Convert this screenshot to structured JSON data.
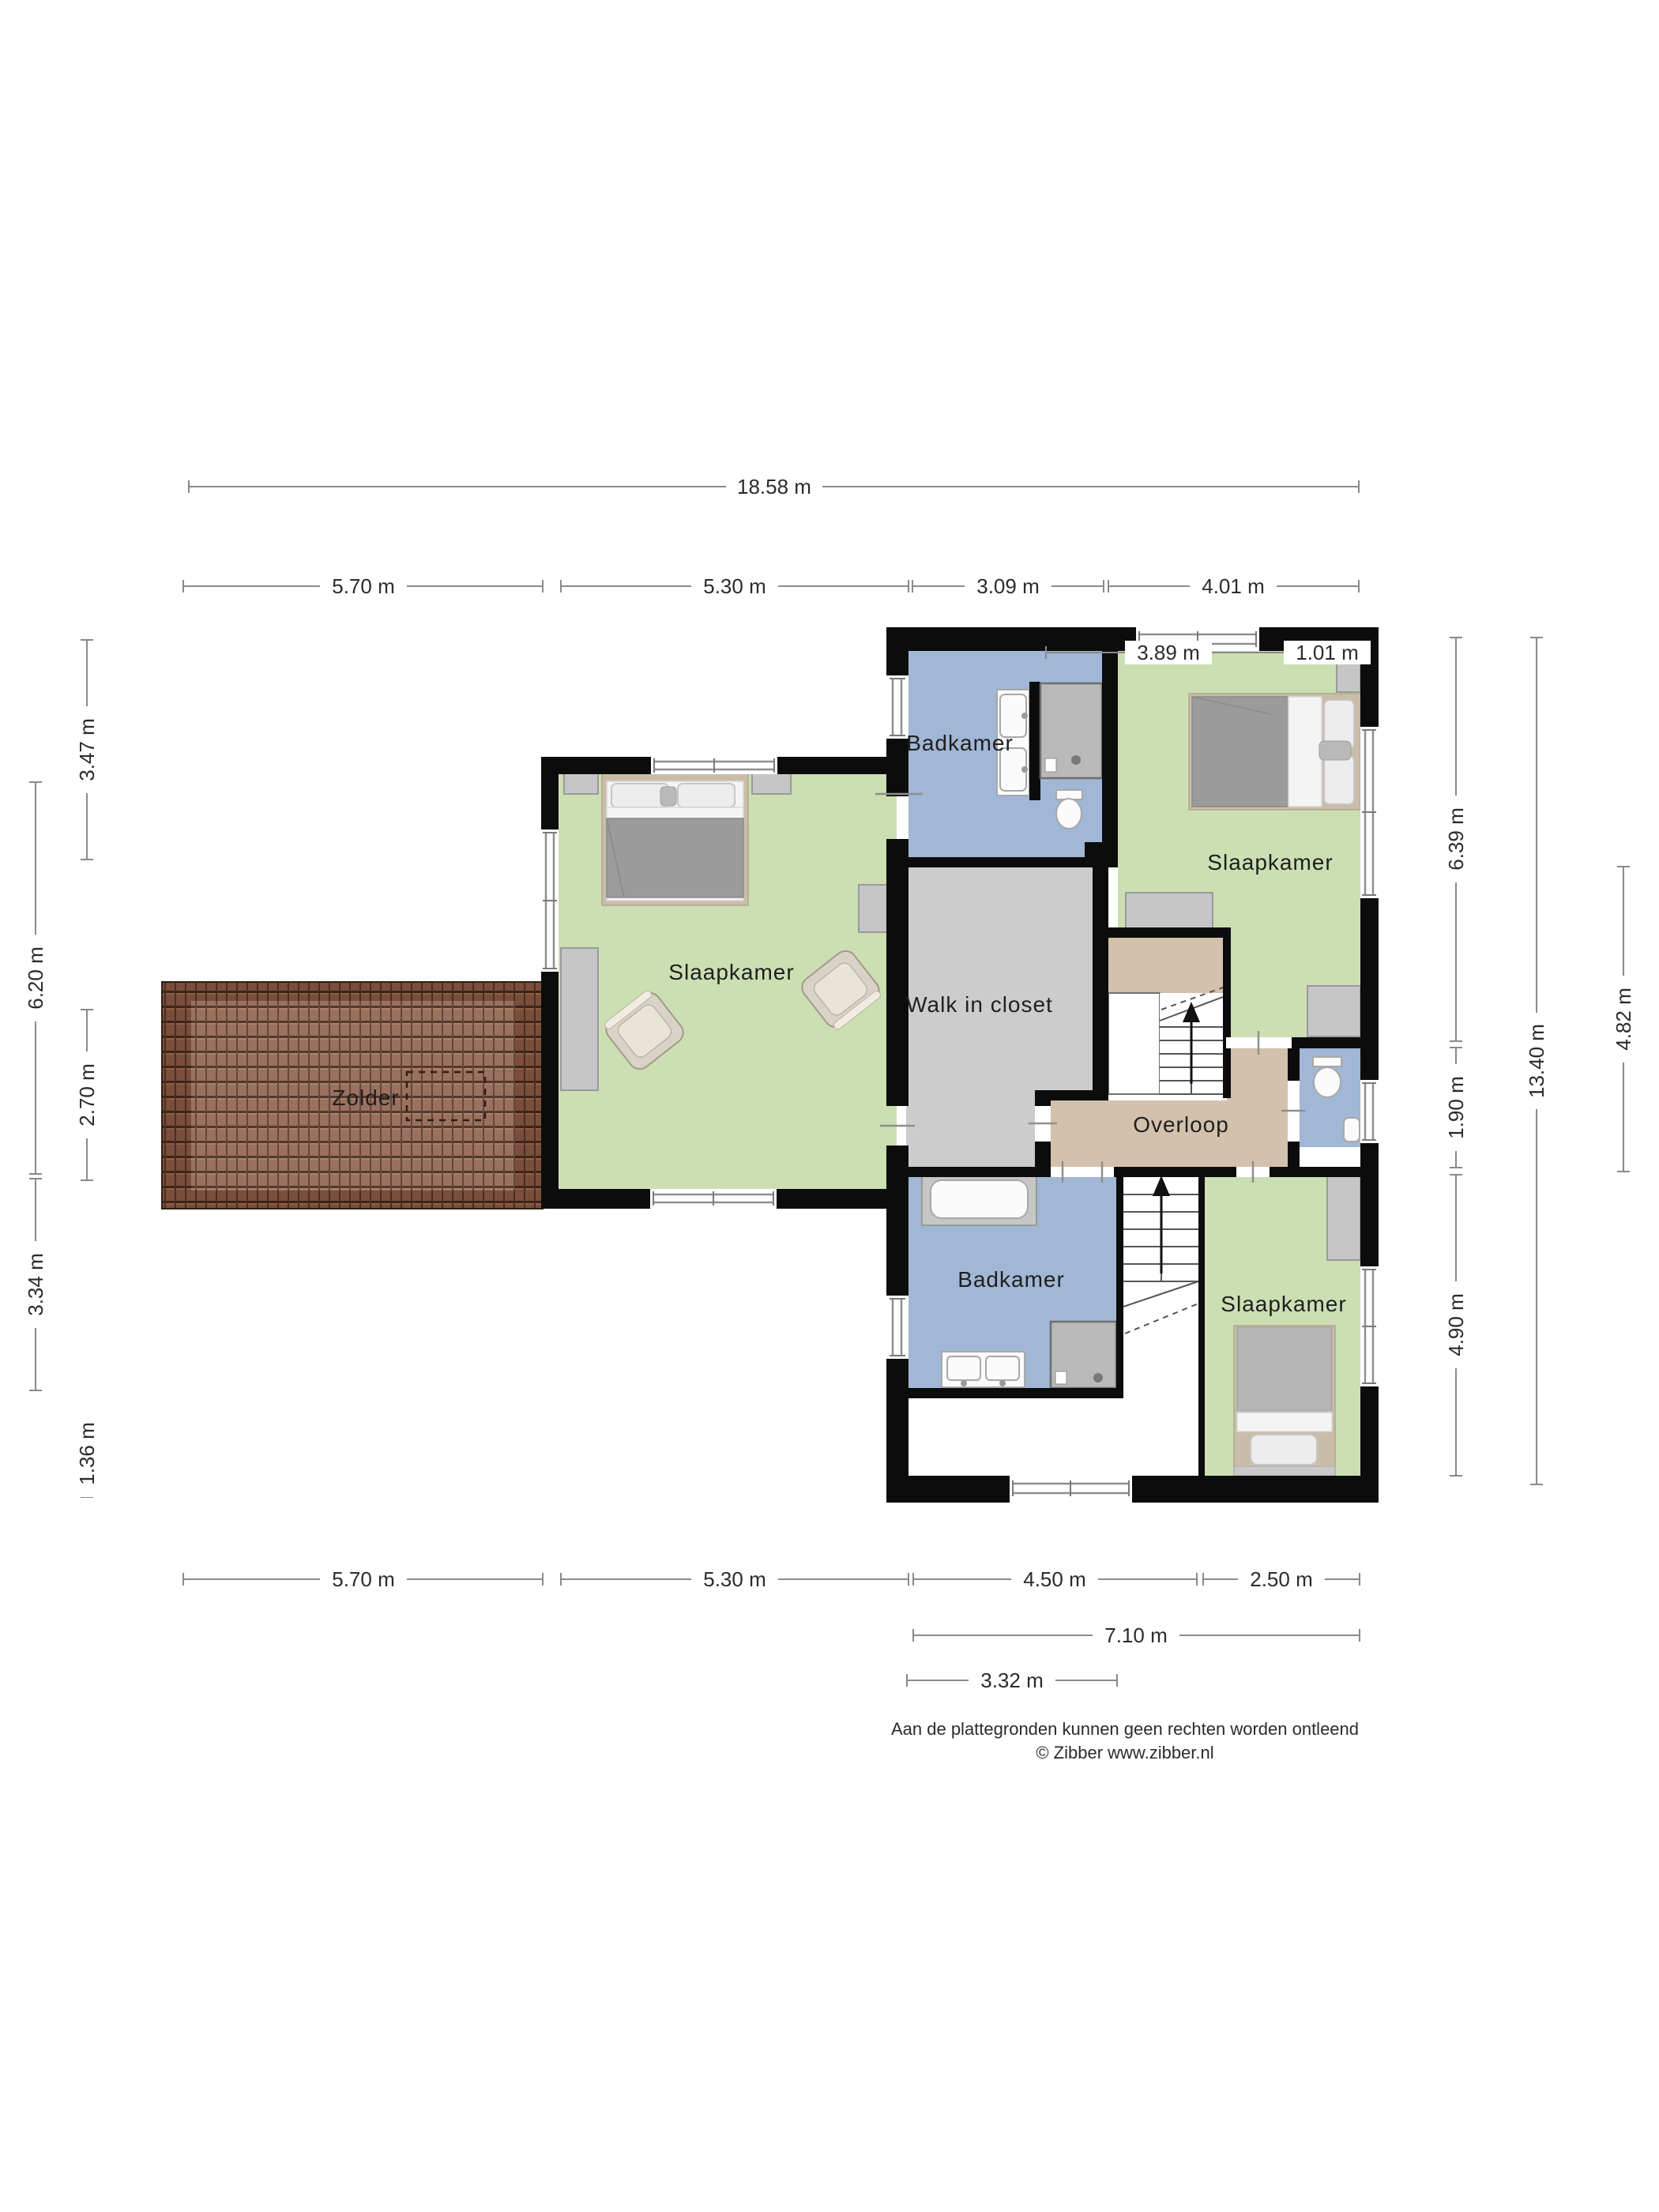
{
  "plan": {
    "type": "floorplan",
    "floor_name": "verdieping (bedroom floor)"
  },
  "rooms": [
    {
      "id": "badkamer-top",
      "label": "Badkamer"
    },
    {
      "id": "slaapkamer-top",
      "label": "Slaapkamer"
    },
    {
      "id": "slaapkamer-left",
      "label": "Slaapkamer"
    },
    {
      "id": "zolder",
      "label": "Zolder"
    },
    {
      "id": "walk-in-closet",
      "label": "Walk in closet"
    },
    {
      "id": "overloop",
      "label": "Overloop"
    },
    {
      "id": "badkamer-bottom",
      "label": "Badkamer"
    },
    {
      "id": "slaapkamer-bottom",
      "label": "Slaapkamer"
    }
  ],
  "dims": {
    "top_total": {
      "label": "18.58 m"
    },
    "top_row": [
      {
        "label": "5.70 m"
      },
      {
        "label": "5.30 m"
      },
      {
        "label": "3.09 m"
      },
      {
        "label": "4.01 m"
      }
    ],
    "top_sub": [
      {
        "label": "3.89 m"
      },
      {
        "label": "1.01 m"
      }
    ],
    "bottom_row": [
      {
        "label": "5.70 m"
      },
      {
        "label": "5.30 m"
      },
      {
        "label": "4.50 m"
      },
      {
        "label": "2.50 m"
      }
    ],
    "bottom_sub": [
      {
        "label": "7.10 m"
      },
      {
        "label": "3.32 m"
      }
    ],
    "left_inner": [
      {
        "label": "3.47 m"
      },
      {
        "label": "2.70 m"
      },
      {
        "label": "1.36 m"
      }
    ],
    "left_outer": [
      {
        "label": "6.20 m"
      },
      {
        "label": "3.34 m"
      }
    ],
    "right_inner": [
      {
        "label": "6.39 m"
      },
      {
        "label": "1.90 m"
      },
      {
        "label": "4.90 m"
      }
    ],
    "right_outer": {
      "label": "13.40 m"
    },
    "right_far": {
      "label": "4.82 m"
    }
  },
  "footer": {
    "disclaimer": "Aan de plattegronden kunnen geen rechten worden ontleend",
    "copyright": "© Zibber www.zibber.nl"
  },
  "colors": {
    "room_green": "#cbdfb3",
    "room_blue": "#a0b7d5",
    "room_tan": "#d3c1ac",
    "room_gray": "#cccccc",
    "wall": "#0c0c0c",
    "roof_border": "#7a4e3c",
    "roof_inner": "#936753"
  }
}
